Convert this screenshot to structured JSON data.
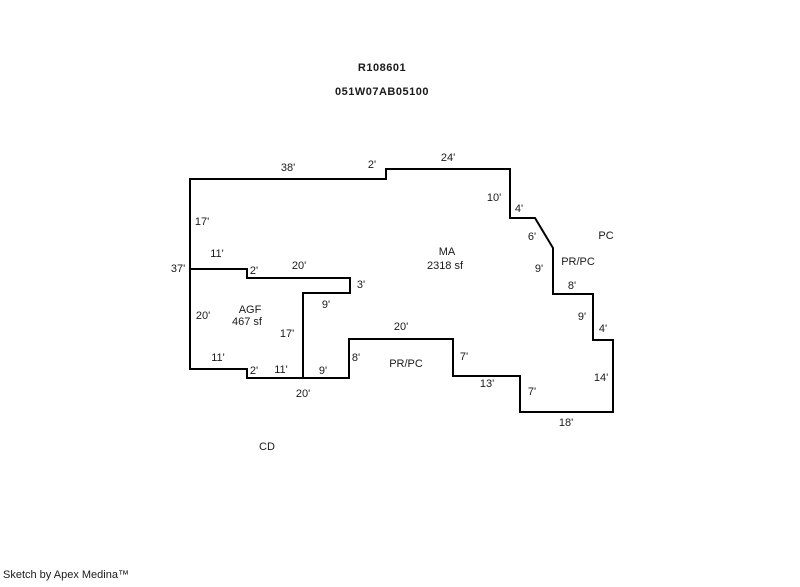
{
  "header": {
    "parcel_id": "R108601",
    "map_taxlot": "051W07AB05100"
  },
  "footer": {
    "credit": "Sketch by Apex Medina™"
  },
  "sketch": {
    "colors": {
      "line": "#000000",
      "text": "#1a1a1a",
      "background": "#ffffff"
    },
    "line_width": 2,
    "outline_closed": [
      [
        190,
        179
      ],
      [
        386,
        179
      ],
      [
        386,
        169
      ],
      [
        510,
        169
      ],
      [
        510,
        218
      ],
      [
        535,
        218
      ],
      [
        553,
        248
      ],
      [
        553,
        294
      ],
      [
        593,
        294
      ],
      [
        593,
        340
      ],
      [
        613,
        340
      ],
      [
        613,
        412
      ],
      [
        520,
        412
      ],
      [
        520,
        376
      ],
      [
        453,
        376
      ],
      [
        453,
        339
      ],
      [
        349,
        339
      ],
      [
        349,
        378
      ],
      [
        247,
        378
      ],
      [
        247,
        369
      ],
      [
        190,
        369
      ]
    ],
    "interior_lines": [
      [
        [
          190,
          269
        ],
        [
          247,
          269
        ],
        [
          247,
          278
        ],
        [
          350,
          278
        ],
        [
          350,
          293
        ],
        [
          303,
          293
        ],
        [
          303,
          378
        ]
      ]
    ],
    "dimension_labels": [
      {
        "text": "38'",
        "x": 288,
        "y": 168
      },
      {
        "text": "2'",
        "x": 372,
        "y": 165
      },
      {
        "text": "24'",
        "x": 448,
        "y": 158
      },
      {
        "text": "10'",
        "x": 494,
        "y": 198
      },
      {
        "text": "4'",
        "x": 519,
        "y": 209
      },
      {
        "text": "6'",
        "x": 532,
        "y": 237
      },
      {
        "text": "9'",
        "x": 539,
        "y": 269
      },
      {
        "text": "8'",
        "x": 572,
        "y": 286
      },
      {
        "text": "9'",
        "x": 582,
        "y": 317
      },
      {
        "text": "4'",
        "x": 603,
        "y": 329
      },
      {
        "text": "14'",
        "x": 601,
        "y": 378
      },
      {
        "text": "7'",
        "x": 532,
        "y": 392
      },
      {
        "text": "18'",
        "x": 566,
        "y": 423
      },
      {
        "text": "13'",
        "x": 487,
        "y": 384
      },
      {
        "text": "7'",
        "x": 464,
        "y": 357
      },
      {
        "text": "20'",
        "x": 401,
        "y": 327
      },
      {
        "text": "8'",
        "x": 356,
        "y": 358
      },
      {
        "text": "3'",
        "x": 361,
        "y": 285
      },
      {
        "text": "9'",
        "x": 326,
        "y": 305
      },
      {
        "text": "17'",
        "x": 287,
        "y": 334
      },
      {
        "text": "20'",
        "x": 299,
        "y": 266
      },
      {
        "text": "2'",
        "x": 254,
        "y": 271
      },
      {
        "text": "11'",
        "x": 217,
        "y": 254
      },
      {
        "text": "20'",
        "x": 203,
        "y": 316
      },
      {
        "text": "11'",
        "x": 218,
        "y": 358
      },
      {
        "text": "2'",
        "x": 254,
        "y": 371
      },
      {
        "text": "11'",
        "x": 281,
        "y": 370
      },
      {
        "text": "9'",
        "x": 323,
        "y": 371
      },
      {
        "text": "20'",
        "x": 303,
        "y": 394
      },
      {
        "text": "37'",
        "x": 178,
        "y": 269
      },
      {
        "text": "17'",
        "x": 202,
        "y": 222
      }
    ],
    "area_labels": [
      {
        "text": "MA",
        "x": 447,
        "y": 252
      },
      {
        "text": "2318 sf",
        "x": 445,
        "y": 266
      },
      {
        "text": "AGF",
        "x": 250,
        "y": 310
      },
      {
        "text": "467 sf",
        "x": 247,
        "y": 322
      },
      {
        "text": "PR/PC",
        "x": 578,
        "y": 262
      },
      {
        "text": "PR/PC",
        "x": 406,
        "y": 364
      },
      {
        "text": "PC",
        "x": 606,
        "y": 236
      },
      {
        "text": "CD",
        "x": 267,
        "y": 447
      }
    ]
  }
}
